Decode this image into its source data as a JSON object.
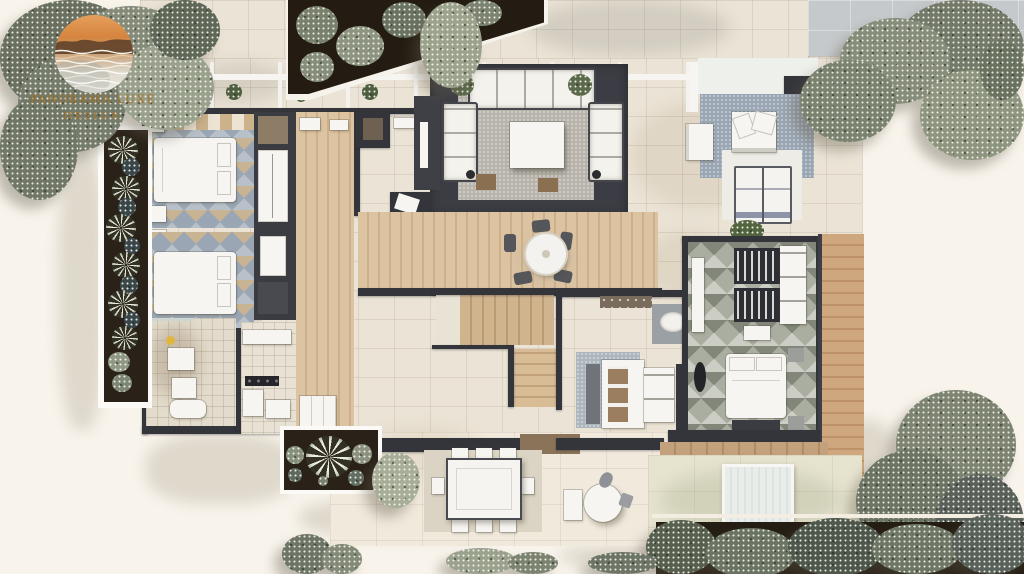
{
  "brand": {
    "line1": "PANORAMA LUXE",
    "line2": "DESIGN"
  },
  "palette": {
    "background": "#f8f4ec",
    "walls": "#34353b",
    "stone_tile": "#ebe4d6",
    "patio_tile": "#f0e9dc",
    "pavement_gray": "#c5c9cb",
    "wood_floor": "#d7bd9b",
    "wood_deck": "#c39a74",
    "glass": "#e2e7e3",
    "furniture_white": "#f6f5f1",
    "rug_blue": "#9aa6b3",
    "rug_gray": "#b8b4ac",
    "rug_sage": "#aaaea0",
    "soil": "#2a2118",
    "foliage_dark": "#5f685c",
    "foliage_mid": "#7e8574",
    "foliage_light": "#9ba08c",
    "logo_orange": "#d5853f",
    "logo_sky": "#e5a05c",
    "logo_gold": "#a8772e",
    "logo_silver": "#edece6"
  },
  "scene": {
    "type": "top-down architectural floor plan render",
    "depicts": [
      "bedroom",
      "bedroom",
      "bathroom",
      "corridor",
      "living-room",
      "dining-area",
      "staircase",
      "kitchen",
      "walk-in-closet",
      "master-bedroom",
      "terrace-lounge",
      "sun-deck",
      "outdoor-patio",
      "garden-beds",
      "trees"
    ]
  }
}
